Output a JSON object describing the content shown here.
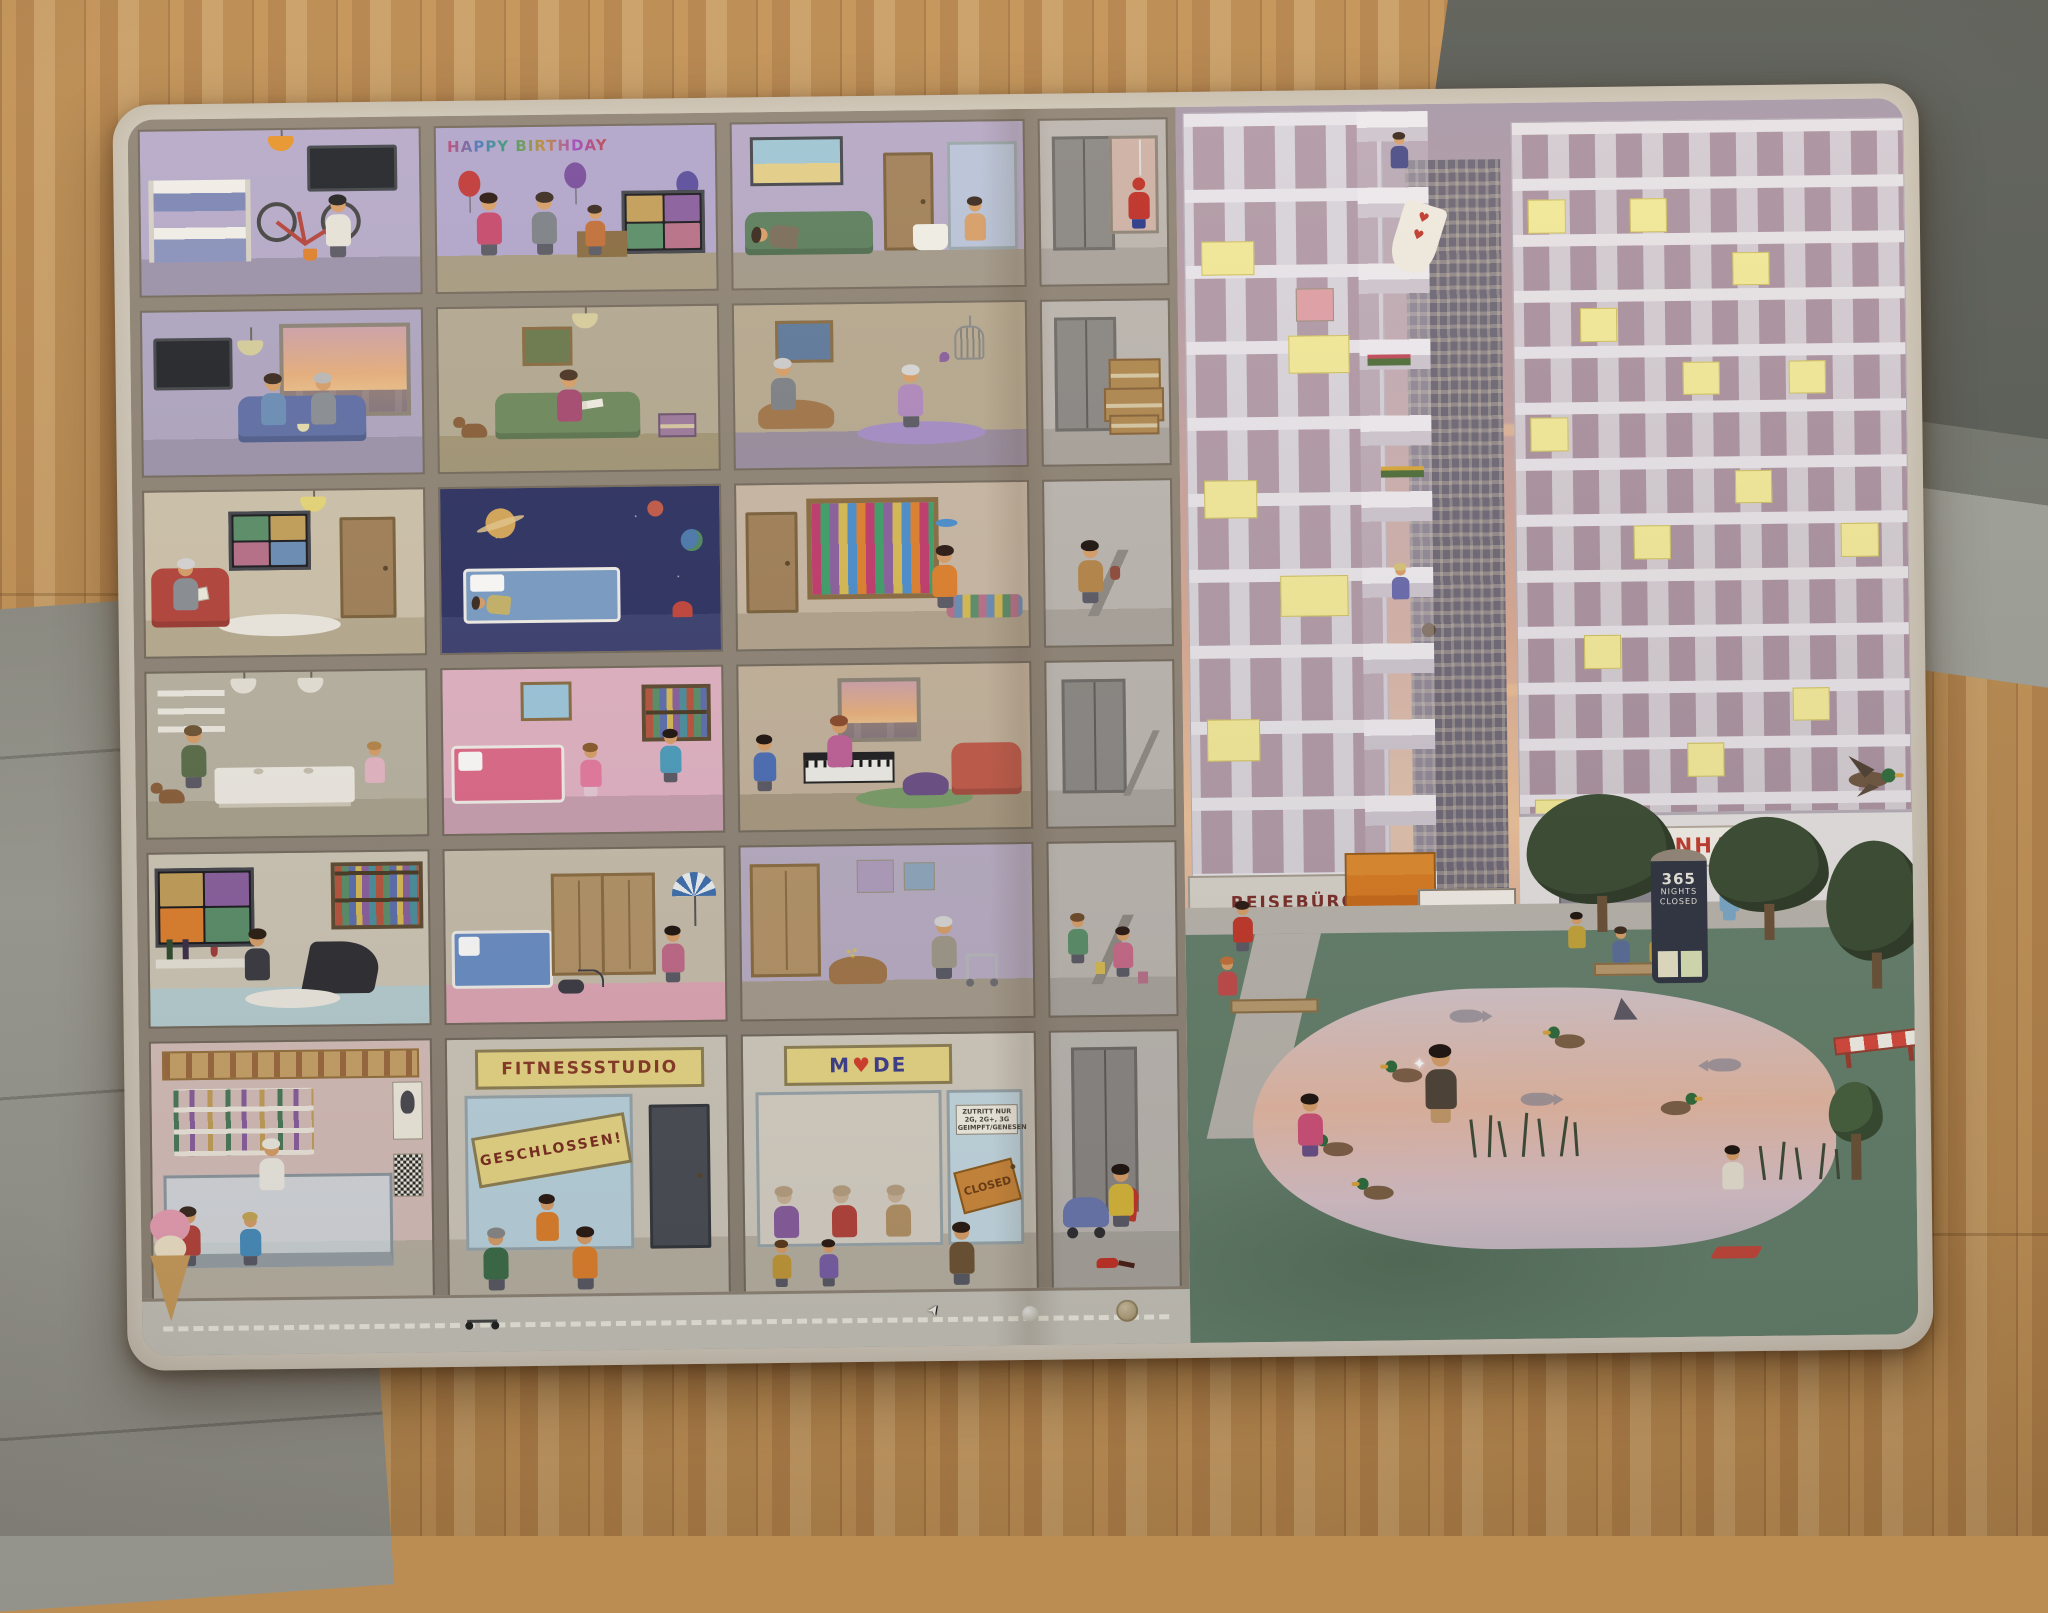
{
  "scene_type": "photo-of-hidden-object-picture-book-on-wood-floor",
  "signs": {
    "happy_birthday": "HAPPY BIRTHDAY",
    "fitnessstudio": "FITNESSSTUDIO",
    "geschlossen": "GESCHLOSSEN!",
    "mode_m": "M",
    "mode_de": "DE",
    "closed_tag": "CLOSED",
    "door_notice_1": "ZUTRITT NUR",
    "door_notice_2": "2G, 2G+, 3G",
    "door_notice_3": "GEIMPFT/GENESEN",
    "krankenhaus": "KRANKENHAUS",
    "reiseburo": "REISEBÜRO",
    "impfzentrum": "Impfzentrum",
    "ad_line_1": "365",
    "ad_line_2": "NIGHTS",
    "ad_line_3": "CLOSED"
  },
  "icons": {
    "heart": "♥",
    "arrow_up": "↑",
    "cursor": "➤",
    "flash": "✦"
  },
  "colors": {
    "wood_floor": "#bb8d52",
    "page_cream": "#d4cdc0",
    "structure_gray": "#8f8578",
    "wall_purple": "#b7accd",
    "sign_yellow": "#ead987",
    "sign_text_red": "#8a3a28",
    "mode_blue": "#3d3f8f",
    "heart_red": "#d6402e",
    "krankenhaus_red": "#c23a2f",
    "sky_peach": "#ecc29b",
    "grass_green": "#64806c",
    "lit_window_yellow": "#f4eb9b",
    "pond_pink": "#e6b9a4"
  }
}
